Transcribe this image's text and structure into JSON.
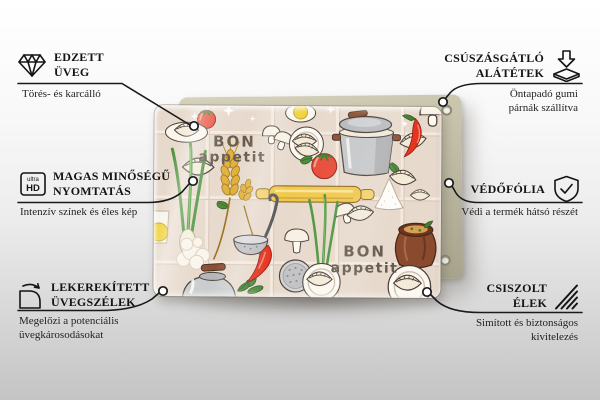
{
  "page": {
    "background_top_color": "#ffffff",
    "background_bottom_color": "#c4c4c4",
    "line_color": "#1a1a1a"
  },
  "product": {
    "backing_color": "#c1bda6",
    "print": {
      "background_color": "#e7d9cc",
      "outline_color": "#4a4038",
      "text_color": "#655a4d",
      "accent_red": "#e5392a",
      "accent_green": "#4e8a3c",
      "accent_yellow": "#f0c84b",
      "accent_gray": "#c3c4c6",
      "accent_brown": "#8a4a2e",
      "text_top": {
        "line1": "BON",
        "line2": "appetit"
      },
      "text_bottom": {
        "line1": "BON",
        "line2": "appetit"
      }
    }
  },
  "callouts": {
    "left": [
      {
        "icon": "diamond-icon",
        "title_line1": "EDZETT",
        "title_line2": "ÜVEG",
        "subtitle_line1": "Törés- és karcálló"
      },
      {
        "icon": "ultra-hd-icon",
        "icon_label_small": "ultra",
        "icon_label_big": "HD",
        "title_line1": "MAGAS MINŐSÉGŰ",
        "title_line2": "NYOMTATÁS",
        "subtitle_line1": "Intenzív színek és éles kép"
      },
      {
        "icon": "rounded-corner-icon",
        "title_line1": "LEKEREKÍTETT",
        "title_line2": "ÜVEGSZÉLEK",
        "subtitle_line1": "Megelőzi a potenciális",
        "subtitle_line2": "üvegkárosodásokat"
      }
    ],
    "right": [
      {
        "icon": "anti-slip-pads-icon",
        "title_line1": "CSÚSZÁSGÁTLÓ",
        "title_line2": "ALÁTÉTEK",
        "subtitle_line1": "Öntapadó gumi",
        "subtitle_line2": "párnák szállítva"
      },
      {
        "icon": "shield-check-icon",
        "title_line1": "VÉDŐFÓLIA",
        "subtitle_line1": "Védi a termék hátsó részét"
      },
      {
        "icon": "polished-edges-icon",
        "title_line1": "CSISZOLT",
        "title_line2": "ÉLEK",
        "subtitle_line1": "Simított és biztonságos",
        "subtitle_line2": "kivitelezés"
      }
    ]
  }
}
